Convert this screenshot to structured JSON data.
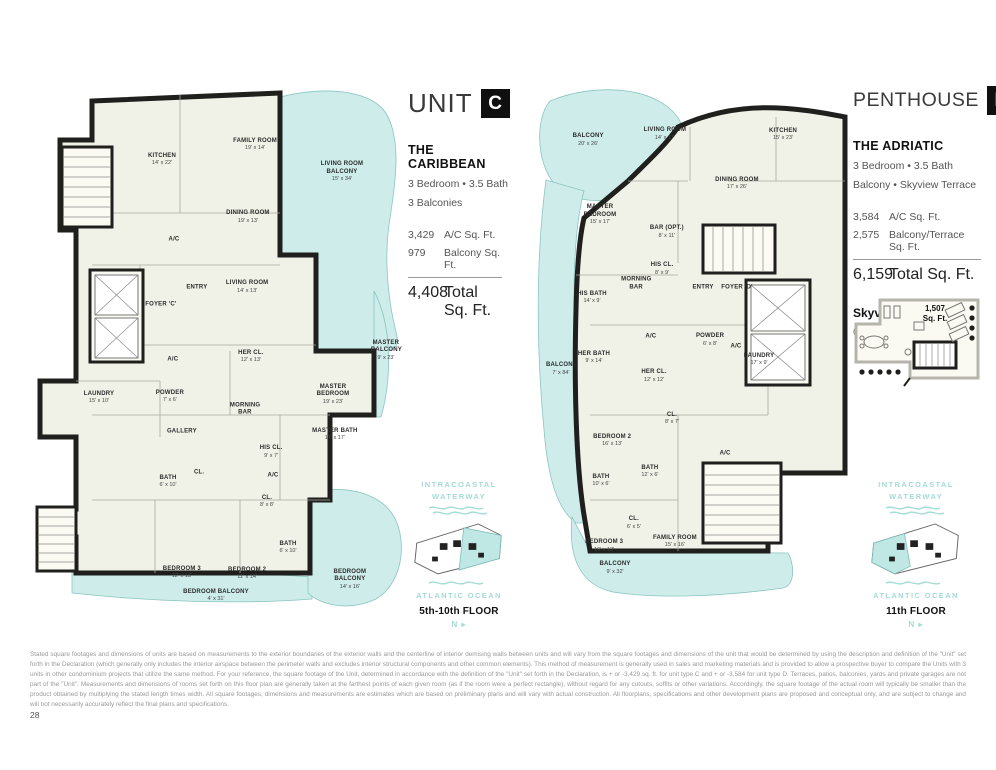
{
  "page": {
    "number": "28",
    "disclaimer": "Stated square footages and dimensions of units are based on measurements to the exterior boundaries of the exterior walls and the centerline of interior demising walls between units and will vary from the square footages and dimensions of the unit that would be determined by using the description and definition of the \"Unit\" set forth in the Declaration (which generally only includes the interior airspace between the perimeter walls and excludes interior structural components and other common elements). This method of measurement is generally used in sales and marketing materials and is provided to allow a prospective buyer to compare the Units with 3 units in other condominium projects that utilize the same  method. For your reference, the square footage of the Unit, determined in accordance with the definition of the \"Unit\" set forth in the Declaration, is + or -3,429  sq. ft. for unit type C and + or -3,584 for unit type D.  Terraces, patios, balconies, yards and private garages are not part of the \"Unit\". Measurements and dimensions of rooms set forth on this floor plan are generally taken at the farthest points of each given room (as if the room were a perfect rectangle), without regard for any cutouts, soffits or other variations.  Accordingly, the square footage of the actual room will typically be smaller than the product obtained by multiplying the stated length times width. All square footages, dimensions and measurements are estimates which are based on preliminary plans and will vary with actual construction. All floorplans, specifications and other development plans are proposed and conceptual only, and are subject to change and will not necessarily accurately reflect the final plans and specifications."
  },
  "keyplan": {
    "waterway": "INTRACOASTAL WATERWAY",
    "ocean": "ATLANTIC OCEAN",
    "north": "N ▸"
  },
  "colors": {
    "balcony_teal": "#cdecea",
    "watermark_teal": "#a4dcd6",
    "wall_black": "#1f1f1d"
  },
  "unit_c": {
    "title": "UNIT",
    "letter": "C",
    "name": "THE CARIBBEAN",
    "specs": [
      "3 Bedroom  •  3.5 Bath",
      "3 Balconies"
    ],
    "stats": [
      {
        "value": "3,429",
        "label": "A/C Sq. Ft."
      },
      {
        "value": "979",
        "label": "Balcony Sq. Ft."
      }
    ],
    "total_value": "4,408",
    "total_label": "Total Sq. Ft.",
    "floor_label": "5th-10th FLOOR",
    "rooms": [
      {
        "label": "KITCHEN",
        "dims": "14' x 22'",
        "x": 35.2,
        "y": 14.0
      },
      {
        "label": "FAMILY ROOM",
        "dims": "19' x 14'",
        "x": 60.0,
        "y": 11.2
      },
      {
        "label": "LIVING ROOM BALCONY",
        "dims": "15' x 34'",
        "x": 83.2,
        "y": 16.3,
        "wrap": true
      },
      {
        "label": "DINING ROOM",
        "dims": "19' x 13'",
        "x": 58.1,
        "y": 24.7
      },
      {
        "label": "A/C",
        "dims": "",
        "x": 38.4,
        "y": 29.0
      },
      {
        "label": "ENTRY",
        "dims": "",
        "x": 44.5,
        "y": 37.9
      },
      {
        "label": "LIVING ROOM",
        "dims": "14' x 13'",
        "x": 57.9,
        "y": 37.8
      },
      {
        "label": "FOYER 'C'",
        "dims": "",
        "x": 34.9,
        "y": 41.1
      },
      {
        "label": "HER CL.",
        "dims": "12' x 13'",
        "x": 58.9,
        "y": 50.8
      },
      {
        "label": "A/C",
        "dims": "",
        "x": 38.1,
        "y": 51.4
      },
      {
        "label": "LAUNDRY",
        "dims": "15' x 10'",
        "x": 18.4,
        "y": 58.5
      },
      {
        "label": "POWDER",
        "dims": "7' x 6'",
        "x": 37.3,
        "y": 58.3
      },
      {
        "label": "MORNING BAR",
        "dims": "",
        "x": 57.3,
        "y": 60.7,
        "narrow": true
      },
      {
        "label": "GALLERY",
        "dims": "",
        "x": 40.5,
        "y": 64.9
      },
      {
        "label": "MASTER BEDROOM",
        "dims": "19' x 23'",
        "x": 80.8,
        "y": 57.9,
        "wrap": true
      },
      {
        "label": "MASTER BALCONY",
        "dims": "9' x 23'",
        "x": 94.9,
        "y": 49.7,
        "narrow": true
      },
      {
        "label": "MASTER BATH",
        "dims": "17' x 17'",
        "x": 81.3,
        "y": 65.4
      },
      {
        "label": "HIS CL.",
        "dims": "9' x 7'",
        "x": 64.3,
        "y": 68.6
      },
      {
        "label": "CL.",
        "dims": "",
        "x": 45.1,
        "y": 72.5
      },
      {
        "label": "A/C",
        "dims": "",
        "x": 64.8,
        "y": 73.1
      },
      {
        "label": "BATH",
        "dims": "6' x 10'",
        "x": 36.8,
        "y": 74.2
      },
      {
        "label": "CL.",
        "dims": "8' x 8'",
        "x": 63.2,
        "y": 77.9
      },
      {
        "label": "BATH",
        "dims": "6' x 10'",
        "x": 68.8,
        "y": 86.5
      },
      {
        "label": "BEDROOM 3",
        "dims": "12' x 13'",
        "x": 40.5,
        "y": 91.2
      },
      {
        "label": "BEDROOM 2",
        "dims": "11' x 14'",
        "x": 57.9,
        "y": 91.4
      },
      {
        "label": "BEDROOM BALCONY",
        "dims": "4' x 31'",
        "x": 49.6,
        "y": 95.5
      },
      {
        "label": "BEDROOM BALCONY",
        "dims": "14' x 16'",
        "x": 85.3,
        "y": 92.5,
        "wrap": true
      }
    ]
  },
  "unit_d": {
    "title": "PENTHOUSE",
    "letter": "D",
    "name": "THE ADRIATIC",
    "specs": [
      "3 Bedroom  •  3.5 Bath",
      "Balcony • Skyview Terrace"
    ],
    "stats": [
      {
        "value": "3,584",
        "label": "A/C Sq. Ft."
      },
      {
        "value": "2,575",
        "label": "Balcony/Terrace Sq. Ft."
      }
    ],
    "total_value": "6,159",
    "total_label": "Total Sq. Ft.",
    "terrace_heading": "Skyview Terrace",
    "terrace_note": "(See page 31 for detail)",
    "terrace_area_value": "1,507",
    "terrace_area_label": "Sq. Ft.",
    "floor_label": "11th FLOOR",
    "rooms": [
      {
        "label": "BALCONY",
        "dims": "20' x 26'",
        "x": 18.8,
        "y": 10.3
      },
      {
        "label": "LIVING ROOM",
        "dims": "14' x 17'",
        "x": 42.8,
        "y": 9.2
      },
      {
        "label": "KITCHEN",
        "dims": "15' x 23'",
        "x": 79.7,
        "y": 9.3
      },
      {
        "label": "DINING ROOM",
        "dims": "17' x 26'",
        "x": 65.3,
        "y": 18.5
      },
      {
        "label": "MASTER BEDROOM",
        "dims": "15' x 17'",
        "x": 22.5,
        "y": 24.3,
        "wrap": true
      },
      {
        "label": "BAR (OPT.)",
        "dims": "8' x 11'",
        "x": 43.4,
        "y": 27.5
      },
      {
        "label": "HIS CL.",
        "dims": "8' x 9'",
        "x": 41.9,
        "y": 34.4
      },
      {
        "label": "MORNING BAR",
        "dims": "",
        "x": 33.8,
        "y": 37.2,
        "narrow": true
      },
      {
        "label": "HIS BATH",
        "dims": "14' x 9'",
        "x": 20.0,
        "y": 39.8
      },
      {
        "label": "ENTRY",
        "dims": "",
        "x": 54.7,
        "y": 37.9
      },
      {
        "label": "FOYER 'D'",
        "dims": "",
        "x": 65.3,
        "y": 37.9
      },
      {
        "label": "BALCONY",
        "dims": "7' x 84'",
        "x": 10.3,
        "y": 53.1,
        "narrow": true
      },
      {
        "label": "HER BATH",
        "dims": "9' x 14'",
        "x": 20.6,
        "y": 51.0
      },
      {
        "label": "A/C",
        "dims": "",
        "x": 38.4,
        "y": 47.1
      },
      {
        "label": "POWDER",
        "dims": "6' x 8'",
        "x": 56.9,
        "y": 47.7
      },
      {
        "label": "A/C",
        "dims": "",
        "x": 65.0,
        "y": 49.0
      },
      {
        "label": "LAUNDRY",
        "dims": "17' x 9'",
        "x": 72.2,
        "y": 51.4
      },
      {
        "label": "HER CL.",
        "dims": "12' x 12'",
        "x": 39.4,
        "y": 54.4
      },
      {
        "label": "CL.",
        "dims": "8' x 7'",
        "x": 45.0,
        "y": 62.4
      },
      {
        "label": "BEDROOM 2",
        "dims": "16' x 13'",
        "x": 26.3,
        "y": 66.5
      },
      {
        "label": "BATH",
        "dims": "10' x 6'",
        "x": 22.8,
        "y": 74.0
      },
      {
        "label": "BATH",
        "dims": "12' x 6'",
        "x": 38.1,
        "y": 72.3
      },
      {
        "label": "A/C",
        "dims": "",
        "x": 61.6,
        "y": 69.0
      },
      {
        "label": "CL.",
        "dims": "6' x 5'",
        "x": 33.1,
        "y": 81.9
      },
      {
        "label": "BEDROOM 3",
        "dims": "16' x 13'",
        "x": 23.8,
        "y": 86.2
      },
      {
        "label": "FAMILY ROOM",
        "dims": "15' x 16'",
        "x": 45.9,
        "y": 85.4
      },
      {
        "label": "BALCONY",
        "dims": "9' x 32'",
        "x": 27.2,
        "y": 90.3
      }
    ]
  }
}
